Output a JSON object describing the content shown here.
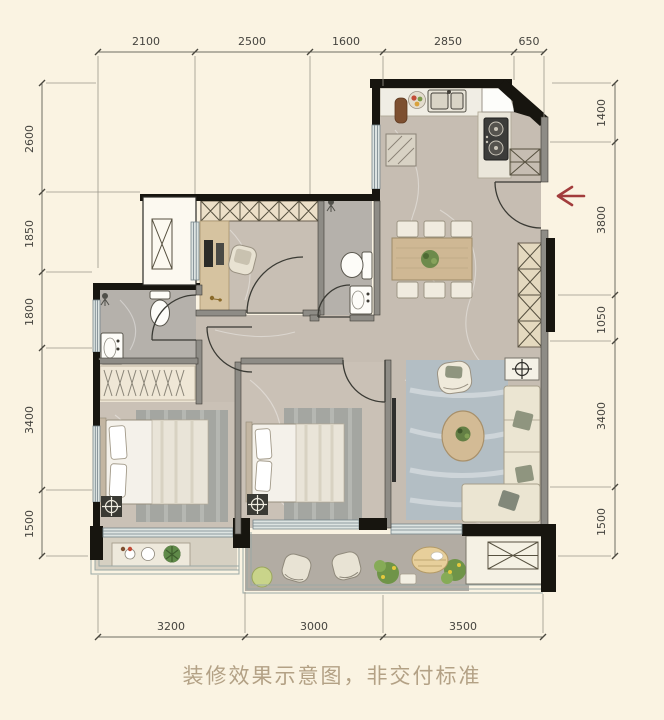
{
  "plan": {
    "caption": "装修效果示意图，非交付标准",
    "dims": {
      "top": [
        "2100",
        "2500",
        "1600",
        "2850",
        "650"
      ],
      "left": [
        "2600",
        "1850",
        "1800",
        "3400",
        "1500"
      ],
      "right": [
        "1400",
        "3800",
        "1050",
        "3400",
        "1500"
      ],
      "bottom": [
        "3200",
        "3000",
        "3500"
      ]
    },
    "colors": {
      "background": "#faf3e2",
      "wall": "#17150f",
      "entry_arrow": "#a23c3c",
      "caption_text": "#b3a185"
    }
  }
}
